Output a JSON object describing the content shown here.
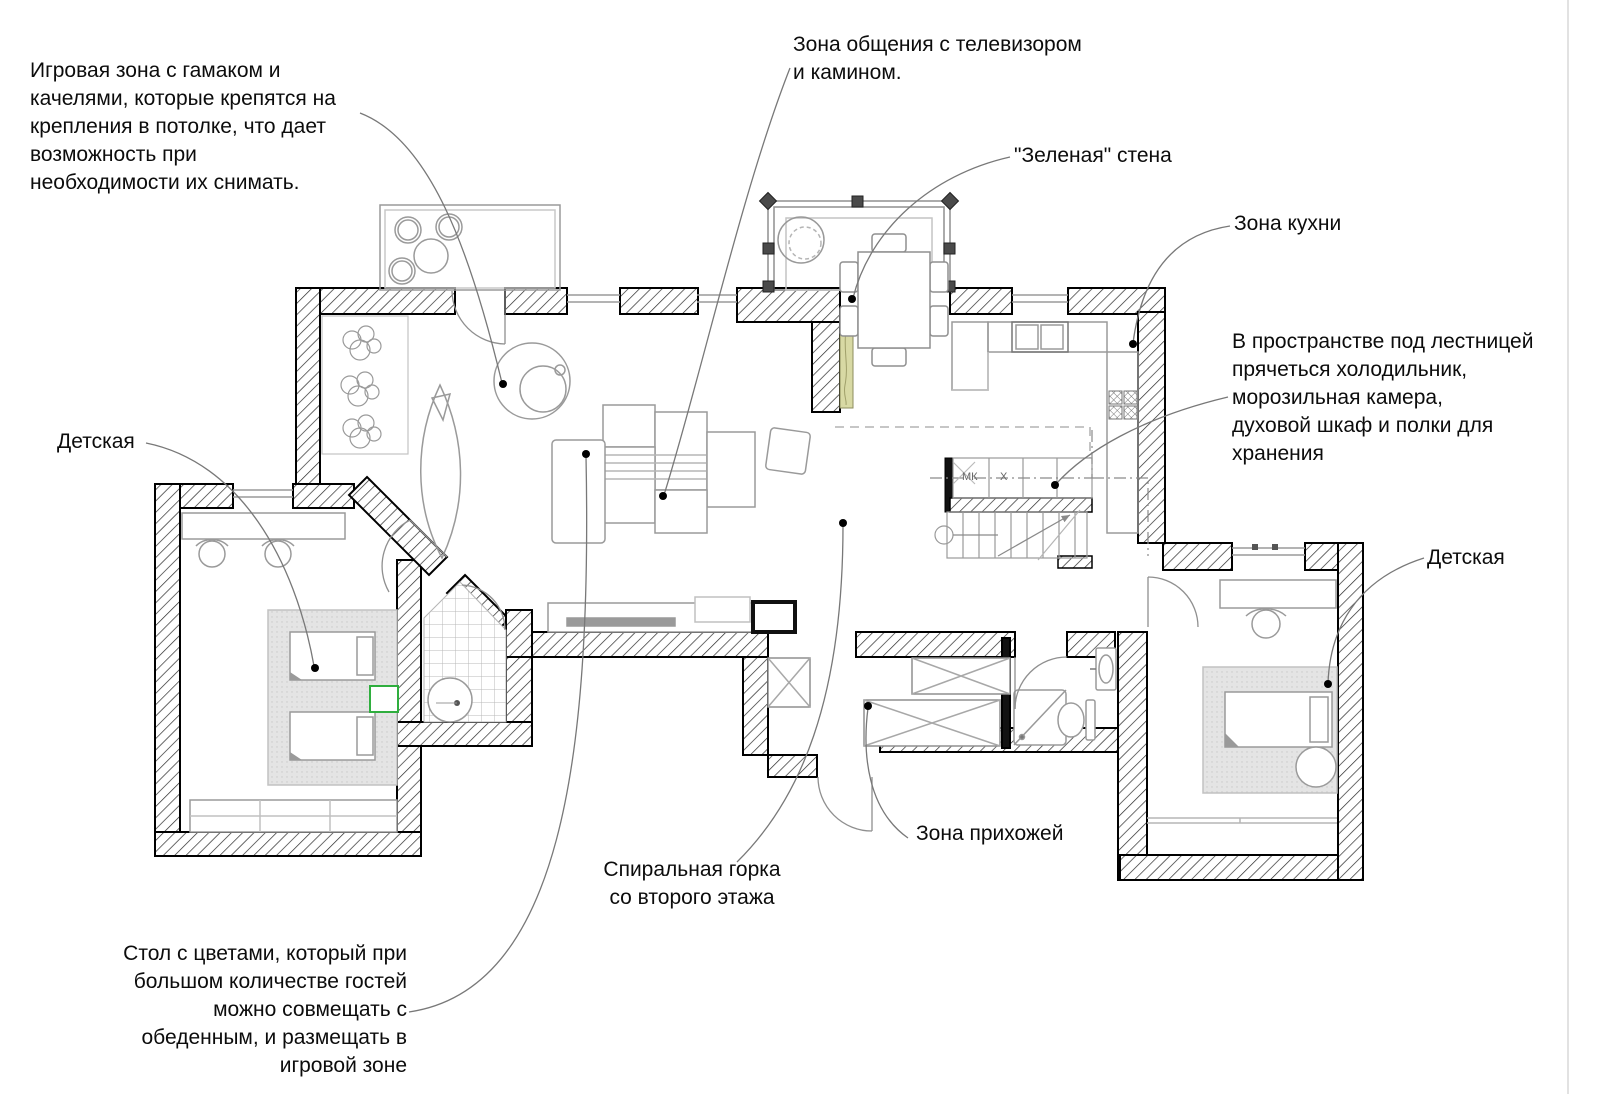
{
  "annotations": {
    "play_zone": {
      "text": "Игровая зона с гамаком и\nкачелями, которые крепятся на\nкрепления в потолке, что дает\nвозможность при\nнеобходимости их снимать."
    },
    "tv_zone": {
      "text": "Зона общения с телевизором\nи камином."
    },
    "green_wall": {
      "text": "\"Зеленая\" стена"
    },
    "kitchen_zone": {
      "text": "Зона кухни"
    },
    "under_stairs": {
      "text": "В пространстве под лестницей\nпрячеться холодильник,\nморозильная камера,\nдуховой шкаф и полки для\nхранения"
    },
    "nursery_left": {
      "text": "Детская"
    },
    "nursery_right": {
      "text": "Детская"
    },
    "hallway_zone": {
      "text": "Зона прихожей"
    },
    "spiral_slide": {
      "text": "Спиральная горка\nсо второго этажа"
    },
    "flower_table": {
      "text": "Стол с цветами, который при\nбольшом количестве гостей\nможно совмещать с\nобеденным, и размещать в\nигровой зоне"
    }
  },
  "plan_labels": {
    "freezer_abbr": "МК",
    "fridge_abbr": "X"
  },
  "colors": {
    "green_wall_strip": "#d8d9a4",
    "nursery_accent_green": "#2fae3e",
    "rug_gray": "#e2e2e2",
    "leader_gray": "#787878",
    "wall_line": "#000000"
  }
}
